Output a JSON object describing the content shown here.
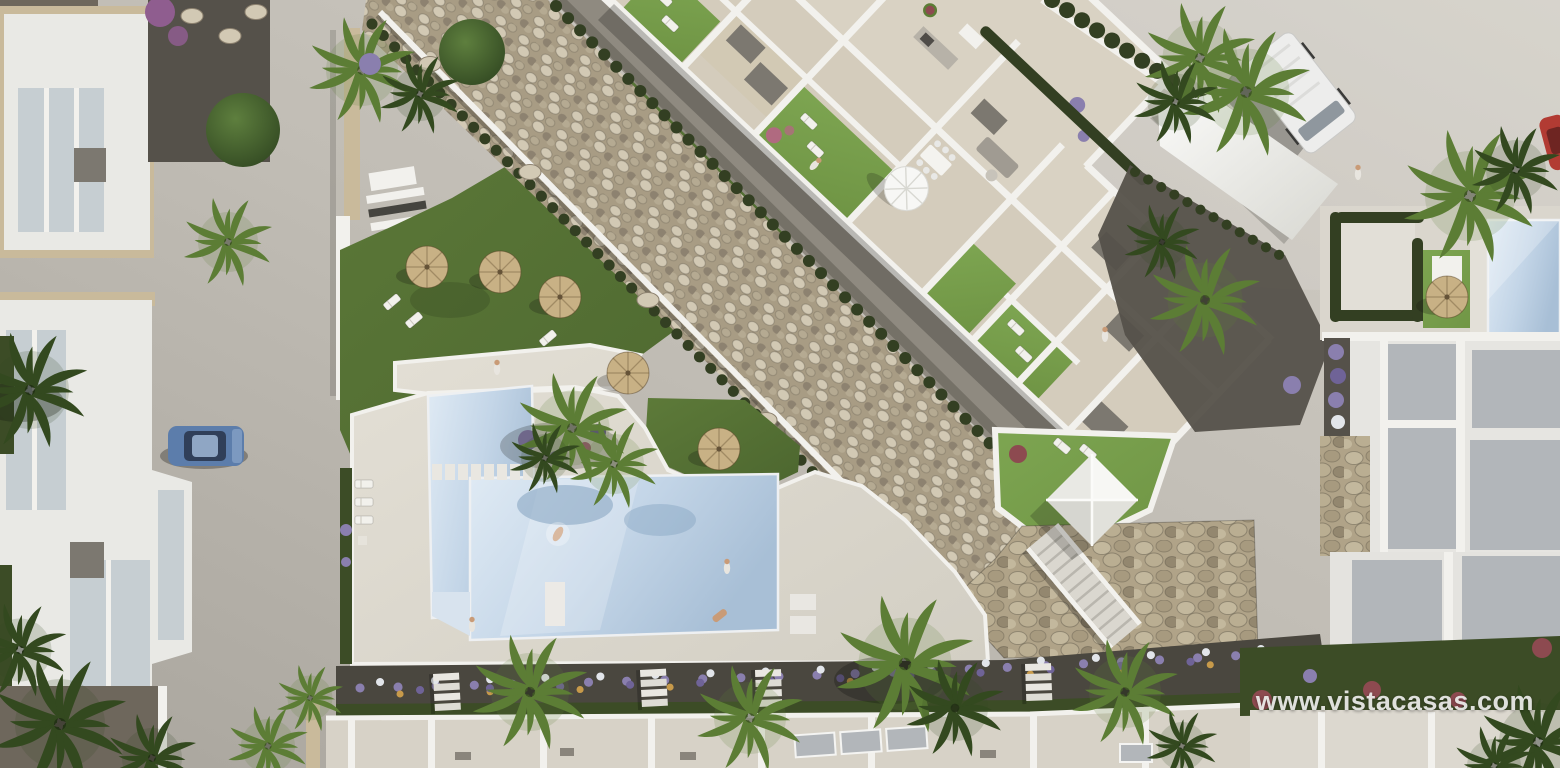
{
  "scene": {
    "description": "Aerial 3D architectural render of a white residential development with communal pool, lawned gardens, pebble landscaping, rooftop terraces and parked vehicles"
  },
  "watermark": {
    "text": "www.vistacasas.com"
  },
  "colors": {
    "road": "#c1bdb5",
    "road_light": "#d3cfc7",
    "road_dark": "#a9a59d",
    "villa_white": "#e9e9e5",
    "wall_white": "#f2f1ed",
    "wall_shade": "#d8d7d1",
    "stone_trim": "#c9ba9b",
    "travertine": "#d9d2c3",
    "travertine_dark": "#cfc7b6",
    "deck_light": "#e3dfd5",
    "deck_dark": "#d1cdc2",
    "roof_dark": "#6e675c",
    "roof_gray": "#b2b6ba",
    "box_gray": "#7c7870",
    "glass": "#c6ced2",
    "lawn": "#6f9444",
    "lawn_light": "#7da551",
    "grass": "#5d7a39",
    "grass_dark": "#4c662f",
    "hedge": "#333f22",
    "foliage_dark": "#3c4c26",
    "palm_light": "#5c7d35",
    "palm_dark": "#33491f",
    "pebble_base": "#a89c84",
    "pebble_light": "#d2c9b4",
    "pebble_mid": "#b5aa92",
    "pebble_dark": "#8d8270",
    "stone_wall": "#b0a388",
    "gravel_dark": "#4a473f",
    "gravel_mid": "#8f8a80",
    "soil_dark": "#55514a",
    "water": "#c3d5e7",
    "water_light": "#dfeaf4",
    "water_deep": "#a8bfd6",
    "water_shadow": "#84a3c0",
    "umbrella_straw": "#c8b185",
    "car_blue": "#5c7dab",
    "car_blue_dark": "#303f59",
    "car_red": "#b23b33",
    "van_white": "#ededec",
    "van_glass": "#8f979e",
    "flower_purple": "#8a7fae",
    "flower_violet": "#6f6397",
    "flower_white": "#e2e5ea",
    "flower_orange": "#c79a4a",
    "flower_pink": "#b06a80",
    "flower_red": "#8d4a50",
    "bougainvillea": "#8f5d8f",
    "skin": "#c99b77",
    "watermark_text": "#ececea"
  }
}
